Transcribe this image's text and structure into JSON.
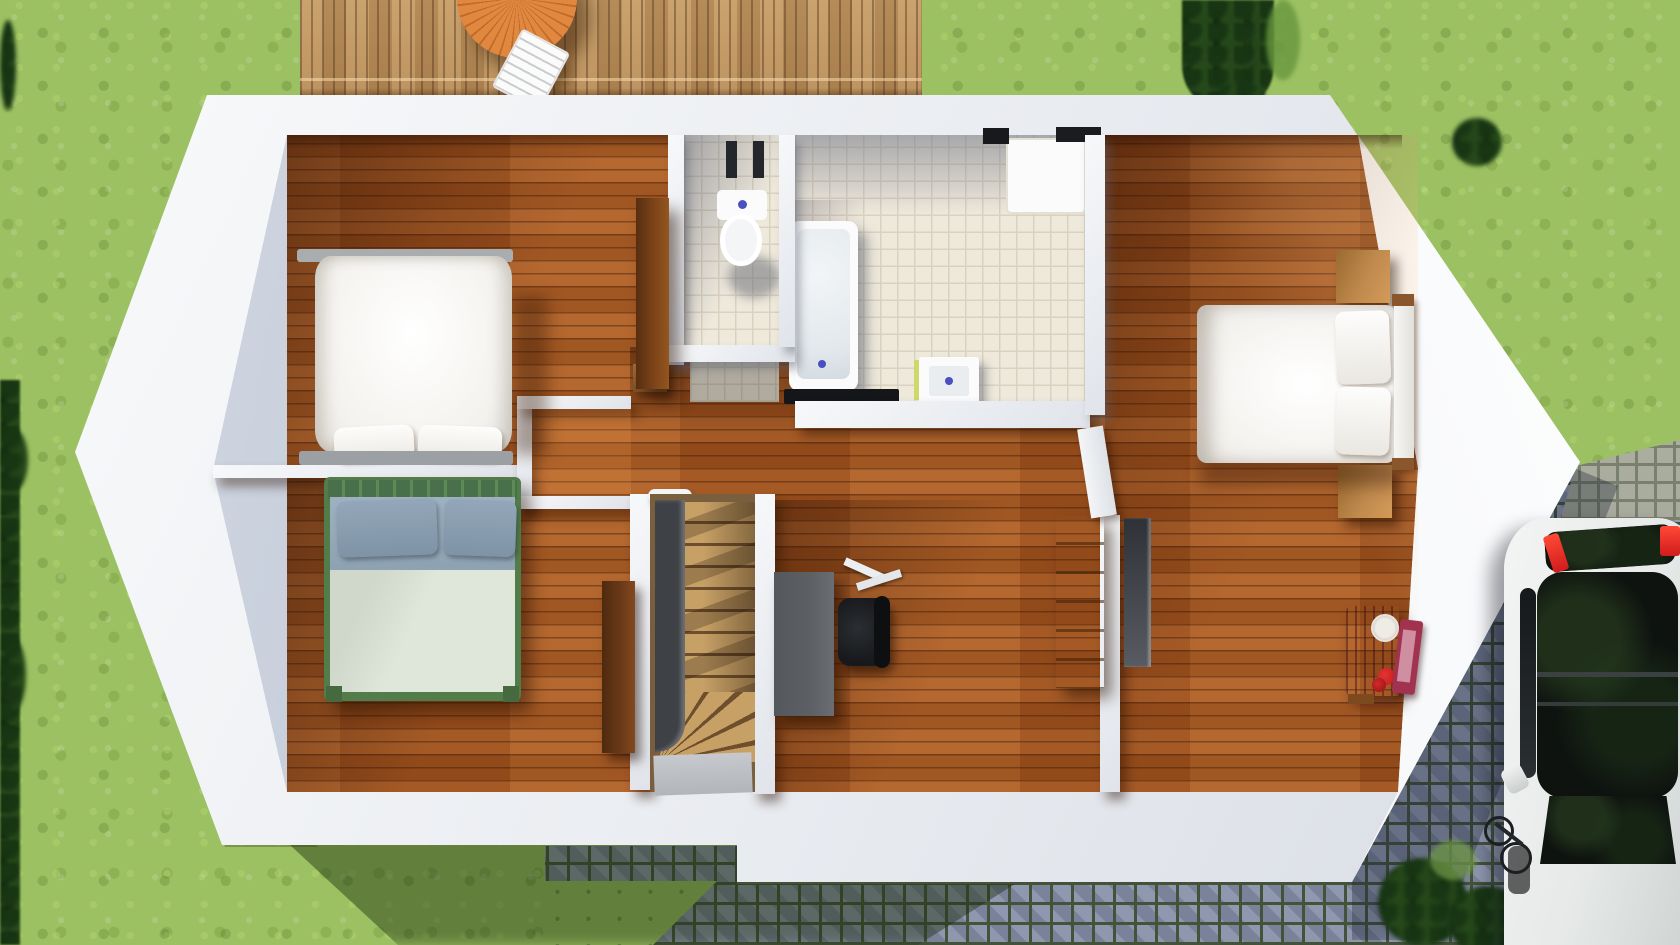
{
  "scene": {
    "title": "Upper-floor 3D floor plan render",
    "description": "Top-down architectural 3D render of an upper storey with garden lawn, wooden terrace with table and chair, cobblestone paving and a parked white car",
    "rooms": [
      {
        "name": "bedroom-top-left",
        "furniture": [
          "white-double-bed",
          "two-pillows",
          "brown-wardrobe"
        ]
      },
      {
        "name": "bedroom-bottom-left",
        "furniture": [
          "green-frame-bed",
          "blue-gray-pillows",
          "brown-door"
        ]
      },
      {
        "name": "wc",
        "furniture": [
          "toilet"
        ]
      },
      {
        "name": "bathroom",
        "furniture": [
          "bathtub",
          "shower-tray",
          "sink-vanity",
          "black-bath-mat",
          "towel"
        ]
      },
      {
        "name": "hallway",
        "furniture": [
          "closet-alcove",
          "wood-bench"
        ]
      },
      {
        "name": "staircase",
        "furniture": [
          "oak-steps",
          "winder-steps",
          "gray-landing",
          "dark-stringer"
        ]
      },
      {
        "name": "study",
        "furniture": [
          "gray-desk",
          "black-office-chair",
          "papers",
          "oak-shelf"
        ]
      },
      {
        "name": "bedroom-right",
        "furniture": [
          "white-double-bed",
          "two-stacked-pillows",
          "wood-headboard",
          "nightstand-north",
          "nightstand-south",
          "dark-wardrobe",
          "pink-vanity-with-mirror",
          "open-white-door"
        ]
      }
    ],
    "exterior": [
      "lawn",
      "left-hedge",
      "tall-hedge-top-right",
      "pine-shrub-corner",
      "wood-deck",
      "round-garden-table",
      "white-garden-chair",
      "cobblestone-path",
      "light-paving-driveway",
      "white-car",
      "bicycle",
      "shrubs-by-car",
      "house-shadow"
    ]
  },
  "palette": {
    "grass": "#9cc162",
    "hedge": "#26441d",
    "deck": "#c49a63",
    "table": "#e08740",
    "wood": "#a8571f",
    "tile": "#efe9dc",
    "tileline": "#d9d2c0",
    "tread": "#c7a066",
    "cobble": "#97a0b5",
    "cobgap": "#45523a",
    "cobgap2": "#79806e",
    "car": "#e6e9e8",
    "glass": "#0e130f",
    "carred": "#d01c1c",
    "oak": "#c8913f",
    "wardrobe": "#6b3a18",
    "darkunit": "#3a3d42",
    "desk": "#5c6064",
    "chair": "#17191c",
    "vanity": "#b43a5e",
    "vanityred": "#c41d1d",
    "bedgray": "#a9adb0",
    "green": "#527c4a",
    "pillowblue": "#93a7b8",
    "duvetblue": "#9eb1c0",
    "duvetpale": "#dfe6da"
  }
}
